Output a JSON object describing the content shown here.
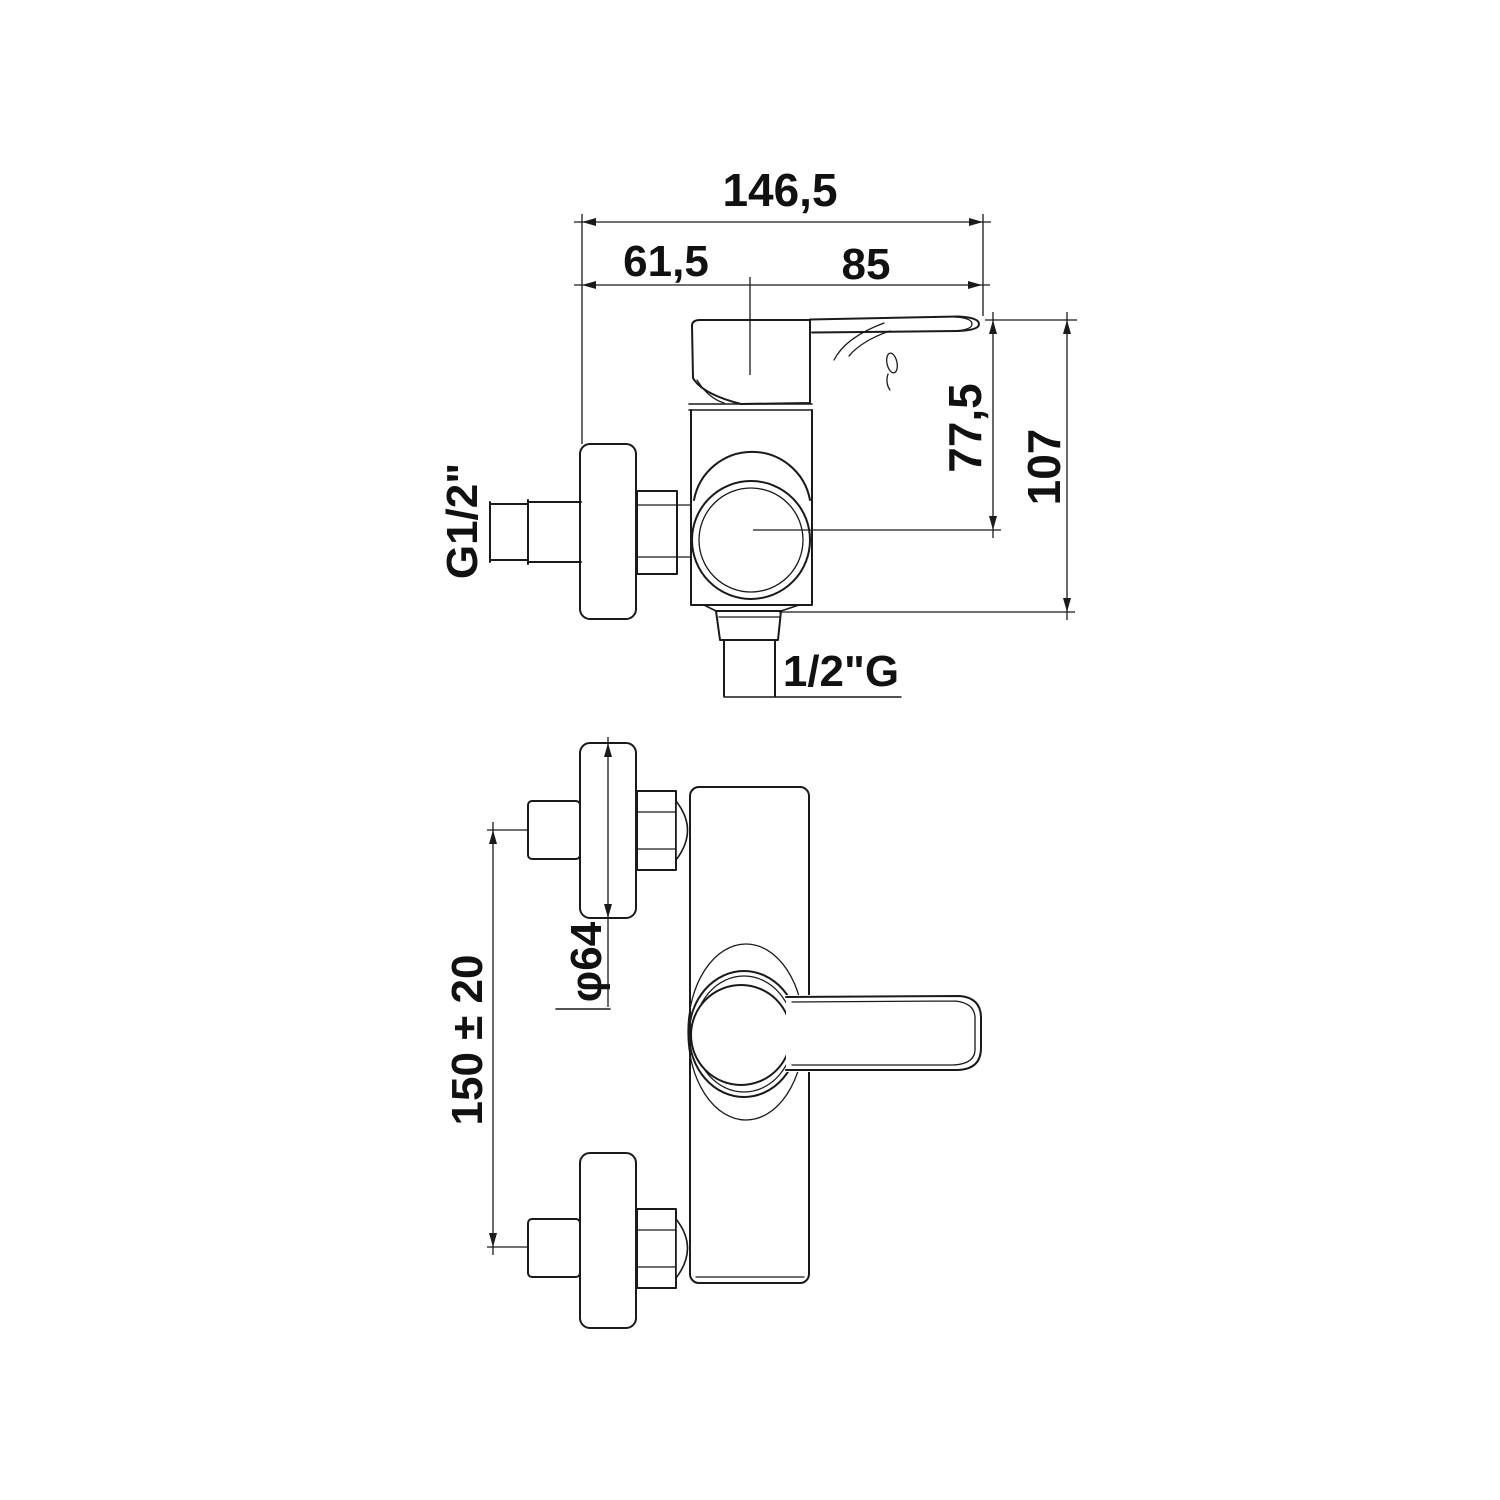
{
  "drawing": {
    "type": "technical-dimension-drawing",
    "views": {
      "side_view": {
        "dims": {
          "overall_width": "146,5",
          "inlet_offset": "61,5",
          "handle_length": "85",
          "height_to_center": "77,5",
          "overall_height": "107",
          "inlet_thread": "G1/2\"",
          "outlet_thread": "1/2\"G"
        }
      },
      "front_view": {
        "dims": {
          "flange_diameter": "φ64",
          "inlet_spacing": "150 ± 20"
        }
      }
    },
    "colors": {
      "line": "#1a1a1a",
      "background": "#ffffff"
    }
  }
}
